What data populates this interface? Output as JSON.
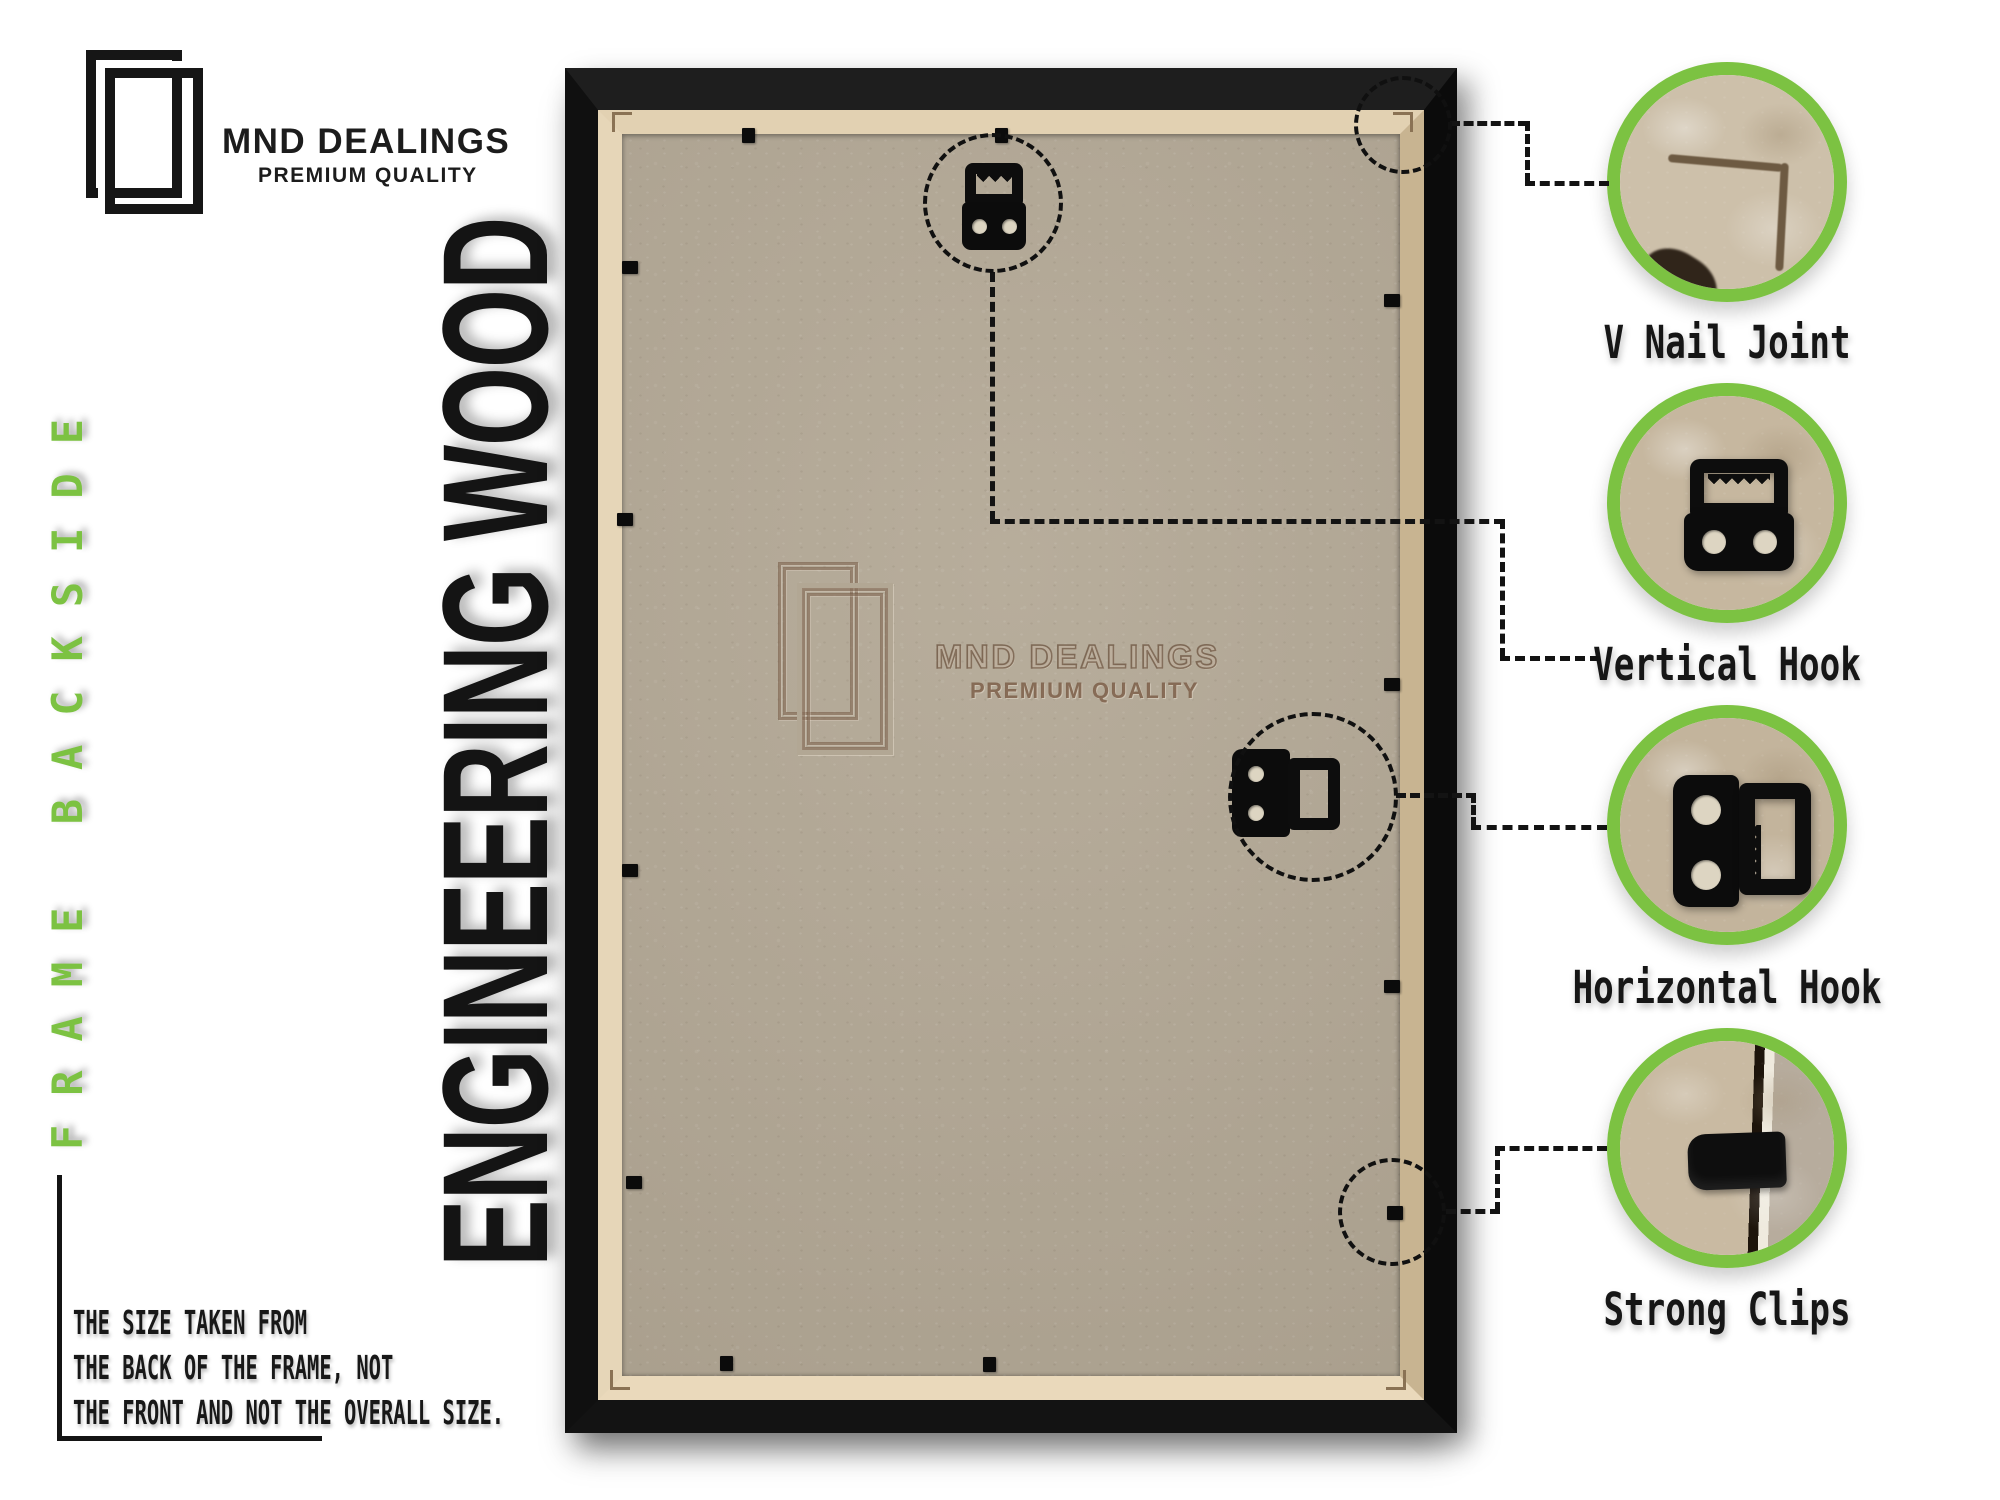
{
  "brand": {
    "name": "MND DEALINGS",
    "tagline": "PREMIUM QUALITY"
  },
  "side_label": "FRAME BACKSIDE",
  "material_label": "ENGINEERING WOOD",
  "watermark": {
    "name": "MND DEALINGS",
    "tagline": "PREMIUM QUALITY"
  },
  "note": {
    "line1": "THE SIZE TAKEN FROM",
    "line2": "THE BACK OF THE FRAME, NOT",
    "line3": "THE FRONT AND NOT THE OVERALL SIZE."
  },
  "callouts": {
    "v_nail": {
      "label": "V Nail Joint"
    },
    "vertical_hook": {
      "label": "Vertical Hook"
    },
    "horizontal_hook": {
      "label": "Horizontal Hook"
    },
    "strong_clips": {
      "label": "Strong Clips"
    }
  },
  "colors": {
    "accent_green": "#7cc242",
    "frame_black": "#141414",
    "board_tan": "#b2a794",
    "mdf_edge": "#e2d1b2",
    "emboss_brown": "#8d7862",
    "line_black": "#131313"
  }
}
